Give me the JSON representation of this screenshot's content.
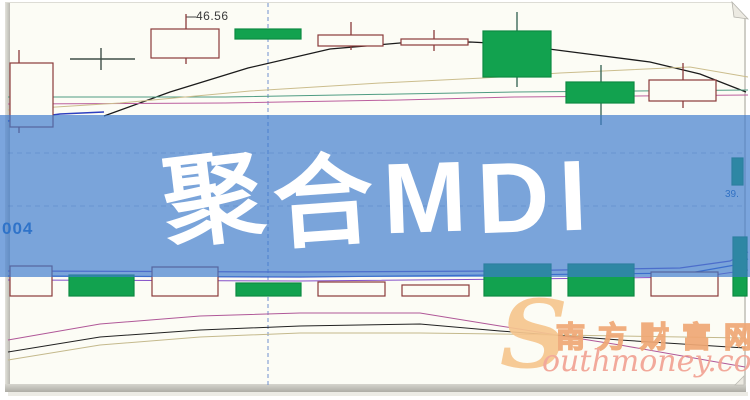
{
  "page": {
    "banner_title": "聚合MDI",
    "banner_chars": [
      {
        "c": "聚",
        "r": -7,
        "ty": 2
      },
      {
        "c": "合",
        "r": -4,
        "ty": 5
      },
      {
        "c": "M",
        "r": -2,
        "ty": 0
      },
      {
        "c": "D",
        "r": -2,
        "ty": 0
      },
      {
        "c": "I",
        "r": -2,
        "ty": -2
      }
    ],
    "banner_color": "rgba(60,122,205,0.68)",
    "labels": {
      "price_tag": "46.56",
      "left_partial": "004",
      "right_partial": "39."
    },
    "watermark": {
      "swoosh": "S",
      "cn": "南方财富网",
      "en": "outhmoney.com",
      "color_orange": "#f0a875",
      "color_pink": "#f2a394"
    }
  },
  "chart_data": {
    "type": "candlestick",
    "title": "聚合MDI",
    "visible_price_label": 46.56,
    "axis_labels_visible": false,
    "grid": {
      "vline_x": 268,
      "vline_color": "#6f8fd0",
      "hlines_y": [
        153,
        206
      ],
      "hline_color": "rgba(50,70,130,0.28)",
      "vline_top": 3,
      "vline_bottom": 385
    },
    "colors": {
      "up_stroke": "#8a3a3a",
      "up_fill": "#fcfcf5",
      "down_fill": "#12a24f",
      "down_stroke": "#0e8a42",
      "wick_down": "#2f5f4f",
      "doji": "#3f4f48"
    },
    "candles_px": [
      {
        "x": 10,
        "w": 43,
        "t": 63,
        "b": 127,
        "wx": 19,
        "wt": 50,
        "wb": 133,
        "k": "up"
      },
      {
        "x": 70,
        "w": 65,
        "t": 59,
        "b": 60,
        "wx": 101,
        "wt": 48,
        "wb": 70,
        "k": "doji"
      },
      {
        "x": 151,
        "w": 68,
        "t": 29,
        "b": 58,
        "wx": 186,
        "wt": 14,
        "wb": 64,
        "k": "up"
      },
      {
        "x": 235,
        "w": 66,
        "t": 29,
        "b": 39,
        "wx": 268,
        "wt": 29,
        "wb": 39,
        "k": "down"
      },
      {
        "x": 318,
        "w": 65,
        "t": 35,
        "b": 46,
        "wx": 351,
        "wt": 22,
        "wb": 50,
        "k": "up"
      },
      {
        "x": 401,
        "w": 67,
        "t": 39,
        "b": 45,
        "wx": 434,
        "wt": 30,
        "wb": 51,
        "k": "up"
      },
      {
        "x": 483,
        "w": 68,
        "t": 31,
        "b": 77,
        "wx": 517,
        "wt": 12,
        "wb": 87,
        "k": "down"
      },
      {
        "x": 566,
        "w": 68,
        "t": 82,
        "b": 103,
        "wx": 601,
        "wt": 65,
        "wb": 125,
        "k": "down"
      },
      {
        "x": 649,
        "w": 67,
        "t": 80,
        "b": 101,
        "wx": 683,
        "wt": 63,
        "wb": 108,
        "k": "up"
      },
      {
        "x": 732,
        "w": 11,
        "t": 158,
        "b": 185,
        "wx": 737,
        "wt": 158,
        "wb": 185,
        "k": "down"
      }
    ],
    "volume_baseline": 296,
    "volume_bars_px": [
      {
        "x": 10,
        "w": 42,
        "t": 266,
        "k": "up"
      },
      {
        "x": 69,
        "w": 65,
        "t": 275,
        "k": "down"
      },
      {
        "x": 152,
        "w": 66,
        "t": 267,
        "k": "up"
      },
      {
        "x": 236,
        "w": 65,
        "t": 283,
        "k": "down"
      },
      {
        "x": 318,
        "w": 67,
        "t": 282,
        "k": "up"
      },
      {
        "x": 402,
        "w": 67,
        "t": 285,
        "k": "up"
      },
      {
        "x": 484,
        "w": 67,
        "t": 264,
        "k": "down"
      },
      {
        "x": 568,
        "w": 66,
        "t": 264,
        "k": "down"
      },
      {
        "x": 651,
        "w": 67,
        "t": 272,
        "k": "up"
      },
      {
        "x": 733,
        "w": 14,
        "t": 237,
        "k": "down"
      }
    ],
    "lines_px": [
      {
        "name": "ma-black",
        "color": "#1b1b1b",
        "w": 1.3,
        "pts": [
          [
            104,
            116
          ],
          [
            170,
            92
          ],
          [
            248,
            68
          ],
          [
            330,
            49
          ],
          [
            400,
            43
          ],
          [
            470,
            42
          ],
          [
            510,
            44
          ],
          [
            580,
            53
          ],
          [
            650,
            62
          ],
          [
            700,
            74
          ],
          [
            746,
            92
          ]
        ]
      },
      {
        "name": "ma-teal",
        "color": "#4f9c82",
        "w": 1,
        "pts": [
          [
            8,
            97
          ],
          [
            225,
            97
          ],
          [
            400,
            94
          ],
          [
            515,
            92
          ],
          [
            748,
            90
          ]
        ]
      },
      {
        "name": "ma-magenta",
        "color": "#bb5f9e",
        "w": 1,
        "pts": [
          [
            8,
            104
          ],
          [
            225,
            103
          ],
          [
            400,
            100
          ],
          [
            515,
            97
          ],
          [
            748,
            95
          ]
        ]
      },
      {
        "name": "ma-tan",
        "color": "#cbbd8d",
        "w": 1,
        "pts": [
          [
            8,
            110
          ],
          [
            120,
            103
          ],
          [
            250,
            91
          ],
          [
            380,
            83
          ],
          [
            483,
            78
          ],
          [
            560,
            73
          ],
          [
            690,
            67
          ],
          [
            748,
            77
          ]
        ]
      },
      {
        "name": "ma-blue",
        "color": "#2d3fbf",
        "w": 1.5,
        "pts": [
          [
            8,
            121
          ],
          [
            60,
            114
          ],
          [
            104,
            112
          ]
        ]
      },
      {
        "name": "tag-line",
        "color": "#444444",
        "w": 1,
        "pts": [
          [
            186,
            17
          ],
          [
            196,
            17
          ]
        ]
      },
      {
        "name": "volma-purple1",
        "color": "#6f54c8",
        "w": 1.2,
        "pts": [
          [
            8,
            271
          ],
          [
            300,
            272
          ],
          [
            500,
            271
          ],
          [
            680,
            268
          ],
          [
            730,
            261
          ],
          [
            748,
            252
          ]
        ]
      },
      {
        "name": "volma-blue",
        "color": "#3a55cc",
        "w": 1.2,
        "pts": [
          [
            8,
            276
          ],
          [
            300,
            277
          ],
          [
            500,
            275
          ],
          [
            690,
            273
          ],
          [
            735,
            265
          ],
          [
            748,
            259
          ]
        ]
      },
      {
        "name": "volma-purple2",
        "color": "#8450c8",
        "w": 1,
        "pts": [
          [
            8,
            280
          ],
          [
            300,
            281
          ],
          [
            520,
            279
          ],
          [
            700,
            277
          ],
          [
            748,
            270
          ]
        ]
      },
      {
        "name": "low-magenta",
        "color": "#b05898",
        "w": 1,
        "pts": [
          [
            8,
            340
          ],
          [
            100,
            324
          ],
          [
            200,
            316
          ],
          [
            300,
            313
          ],
          [
            420,
            313
          ],
          [
            500,
            326
          ],
          [
            620,
            345
          ],
          [
            745,
            367
          ]
        ]
      },
      {
        "name": "low-black",
        "color": "#222222",
        "w": 1,
        "pts": [
          [
            8,
            352
          ],
          [
            100,
            337
          ],
          [
            200,
            330
          ],
          [
            300,
            326
          ],
          [
            420,
            324
          ],
          [
            500,
            331
          ],
          [
            620,
            340
          ],
          [
            745,
            348
          ]
        ]
      },
      {
        "name": "low-tan",
        "color": "#c4b98c",
        "w": 1,
        "pts": [
          [
            8,
            360
          ],
          [
            100,
            345
          ],
          [
            200,
            337
          ],
          [
            300,
            333
          ],
          [
            420,
            333
          ],
          [
            500,
            334
          ],
          [
            620,
            336
          ],
          [
            745,
            338
          ]
        ]
      }
    ]
  }
}
